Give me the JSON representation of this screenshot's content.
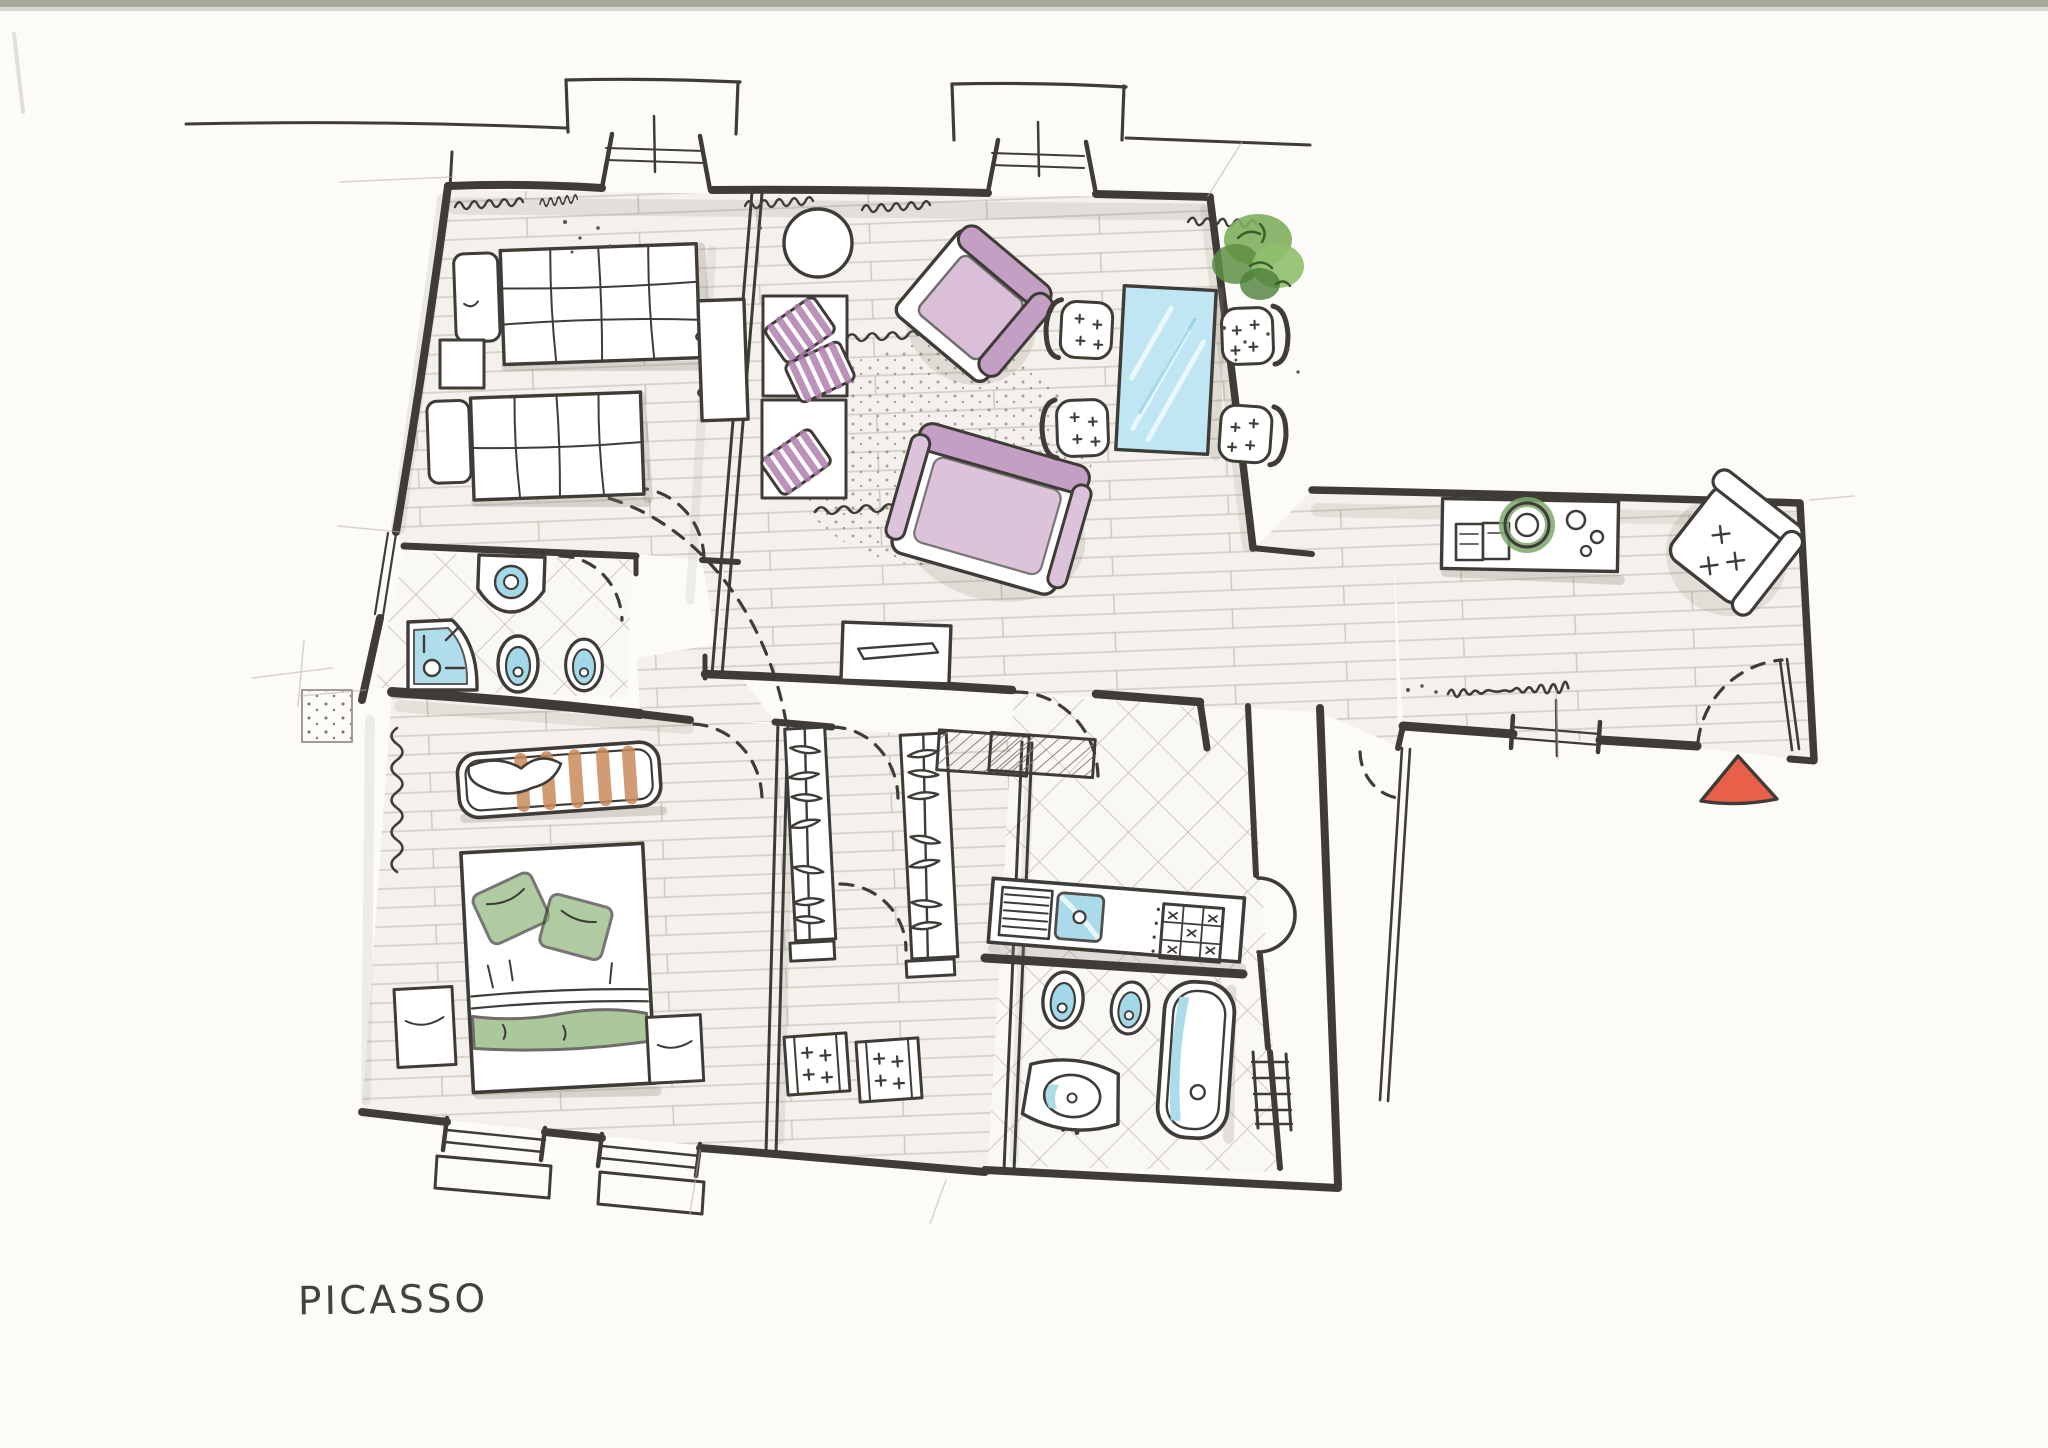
{
  "title": "PICASSO",
  "drawing": {
    "kind": "hand-drawn apartment floor plan sketch",
    "plan_label": "PICASSO"
  },
  "palette": {
    "ink": "#3f3c38",
    "paper": "#fcfbf8",
    "plank_line": "#d6cfc7",
    "tile_line": "#c3bcb2",
    "graphite_shadow": "#8d857b",
    "water_blue": "#a3d8e8",
    "glass_blue": "#bfe6f2",
    "sofa_mauve": "#c49fc4",
    "pillow_stripe": "#b27fae",
    "plant_green": "#7fae5e",
    "bed_green": "#8fb57c",
    "chair_green": "#7ea86b",
    "crib_orange": "#c9895c",
    "entry_red": "#e8604a"
  },
  "rooms": [
    "twin-bedroom",
    "living-dining-room",
    "study-hall",
    "hallway",
    "small-bathroom",
    "double-bedroom",
    "walk-in-closet",
    "kitchenette",
    "main-bathroom",
    "entry-corridor"
  ],
  "icons": [
    "twin-bed",
    "nightstand",
    "console-cabinet",
    "round-table",
    "bench-seat",
    "striped-pillow",
    "armchair",
    "sofa",
    "glass-dining-table",
    "dining-chair",
    "potted-plant",
    "tv-console",
    "desk",
    "office-chair",
    "open-book",
    "wall-sink",
    "toilet",
    "bidet",
    "corner-shower",
    "bathtub",
    "kitchen-sink",
    "stove-top",
    "towel-radiator",
    "wardrobe-rail",
    "clothes-hanger",
    "shoe-bench",
    "crib",
    "double-bed",
    "radiator-zigzag",
    "door-swing",
    "window",
    "entry-arrow"
  ]
}
